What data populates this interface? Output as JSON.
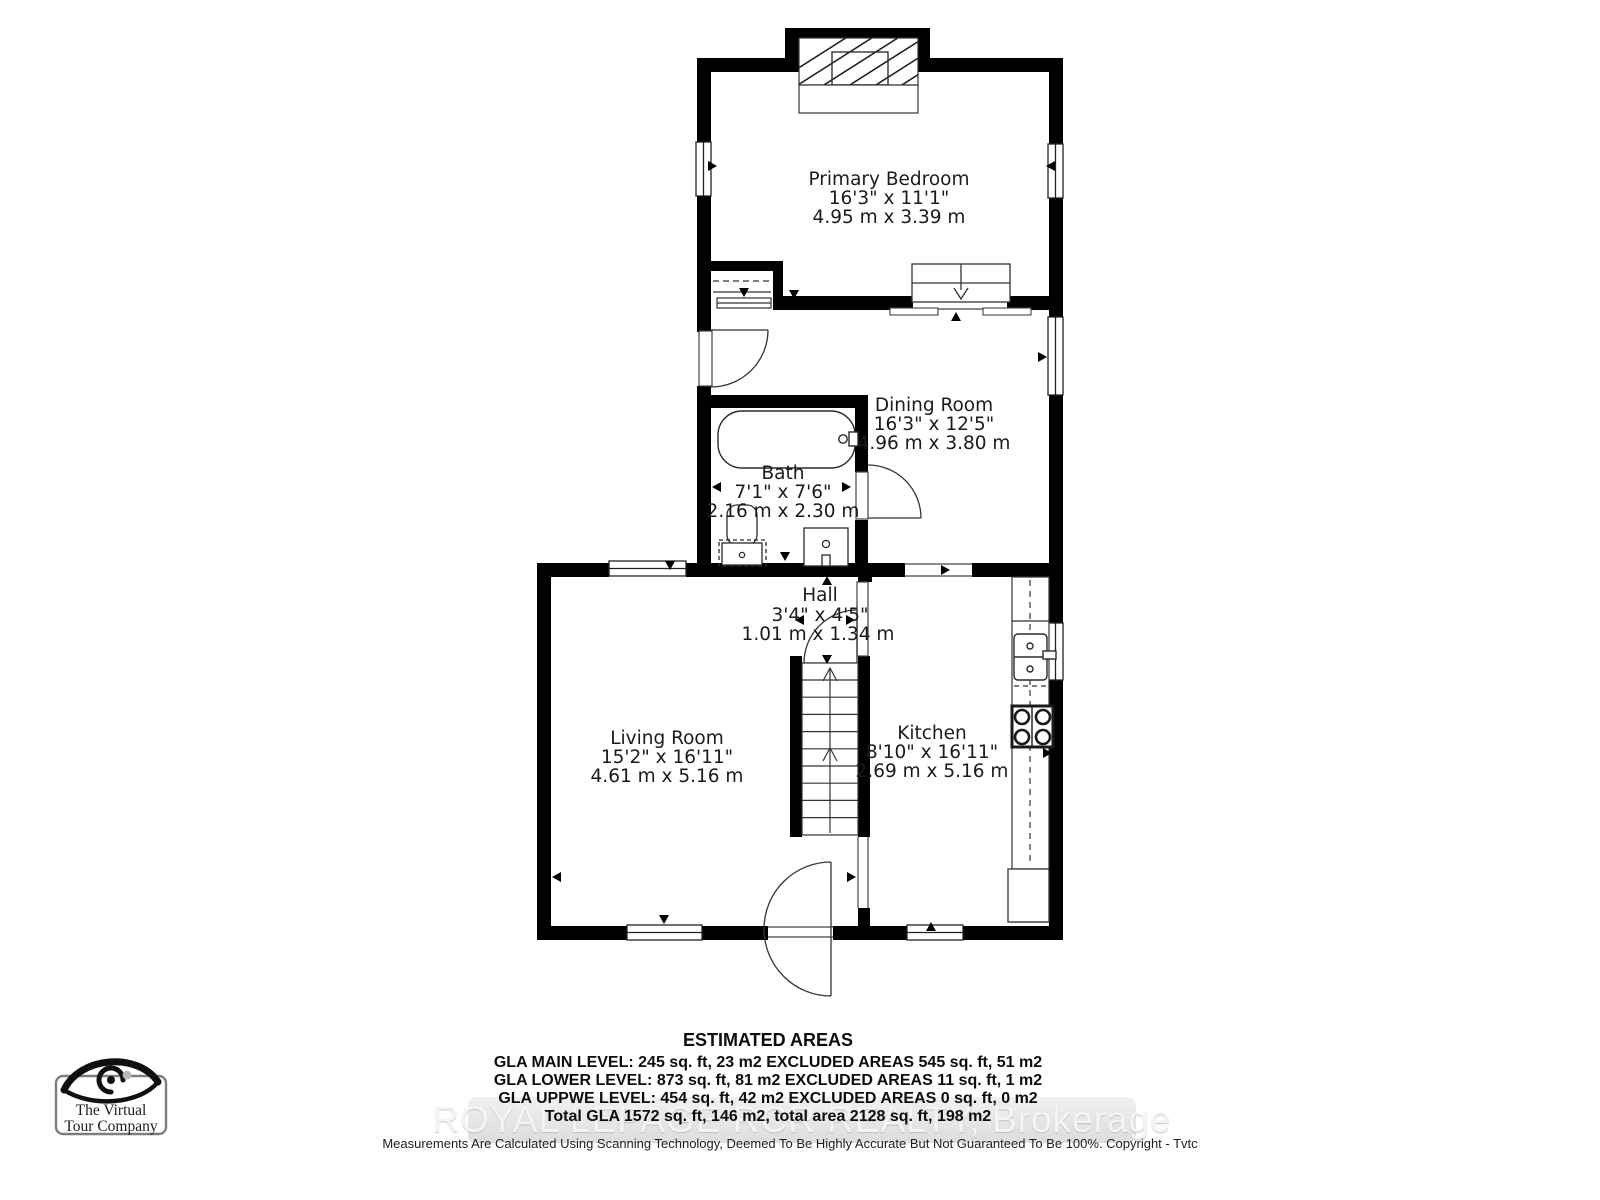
{
  "plan": {
    "rooms": [
      {
        "name": "Primary Bedroom",
        "imperial": "16'3\" x 11'1\"",
        "metric": "4.95 m x 3.39 m"
      },
      {
        "name": "Dining Room",
        "imperial": "16'3\" x 12'5\"",
        "metric": "4.96 m x 3.80 m"
      },
      {
        "name": "Bath",
        "imperial": "7'1\" x 7'6\"",
        "metric": "2.16 m x 2.30 m"
      },
      {
        "name": "Hall",
        "imperial": "3'4\" x 4'5\"",
        "metric": "1.01 m x 1.34 m"
      },
      {
        "name": "Living Room",
        "imperial": "15'2\" x 16'11\"",
        "metric": "4.61 m x 5.16 m"
      },
      {
        "name": "Kitchen",
        "imperial": "8'10\" x 16'11\"",
        "metric": "2.69 m x 5.16 m"
      }
    ]
  },
  "areas": {
    "title": "ESTIMATED AREAS",
    "lines": [
      "GLA MAIN LEVEL: 245 sq. ft, 23 m2 EXCLUDED AREAS 545 sq. ft, 51 m2",
      "GLA LOWER LEVEL: 873 sq. ft, 81 m2 EXCLUDED AREAS 11 sq. ft, 1 m2",
      "GLA UPPWE LEVEL: 454 sq. ft, 42 m2 EXCLUDED AREAS 0 sq. ft, 0 m2",
      "Total GLA 1572 sq. ft, 146 m2, total area 2128 sq. ft, 198 m2"
    ]
  },
  "watermark": "ROYAL LEPAGE RCR REALTY, Brokerage",
  "disclaimer": "Measurements Are Calculated Using Scanning Technology, Deemed To Be Highly Accurate But Not Guaranteed To Be 100%. Copyright - Tvtc",
  "logo": {
    "line1": "The Virtual",
    "line2": "Tour Company"
  },
  "colors": {
    "wall": "#000000",
    "line": "#333333",
    "watermark_text": "#f4f4f4",
    "watermark_band": "#e2e2e2"
  }
}
